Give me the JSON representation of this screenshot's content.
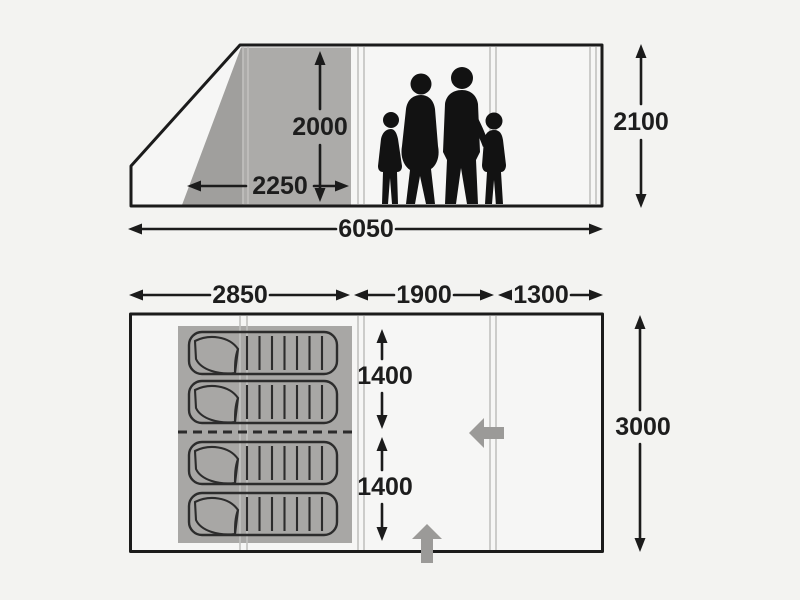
{
  "colors": {
    "background": "#f3f3f1",
    "panel": "#f6f6f5",
    "outline": "#1b1b1b",
    "shaded_area": "#acaba9",
    "shaded_area_dark": "#a09f9d",
    "floor_shaded_area": "#a8a7a5",
    "seam_line": "#c2c1bf",
    "door_arrow": "#9b9a98",
    "silhouette": "#121212"
  },
  "side_view": {
    "labels": {
      "front_height": "2000",
      "front_depth": "2250",
      "total_length": "6050",
      "total_height": "2100"
    },
    "family_figures": 4
  },
  "floor_plan": {
    "labels": {
      "bedroom_length": "2850",
      "living_length": "1900",
      "porch_length": "1300",
      "bedroom1_depth": "1400",
      "bedroom2_depth": "1400",
      "total_width": "3000"
    },
    "sleeping_bags": 4,
    "door_arrows": [
      "left",
      "up"
    ]
  }
}
